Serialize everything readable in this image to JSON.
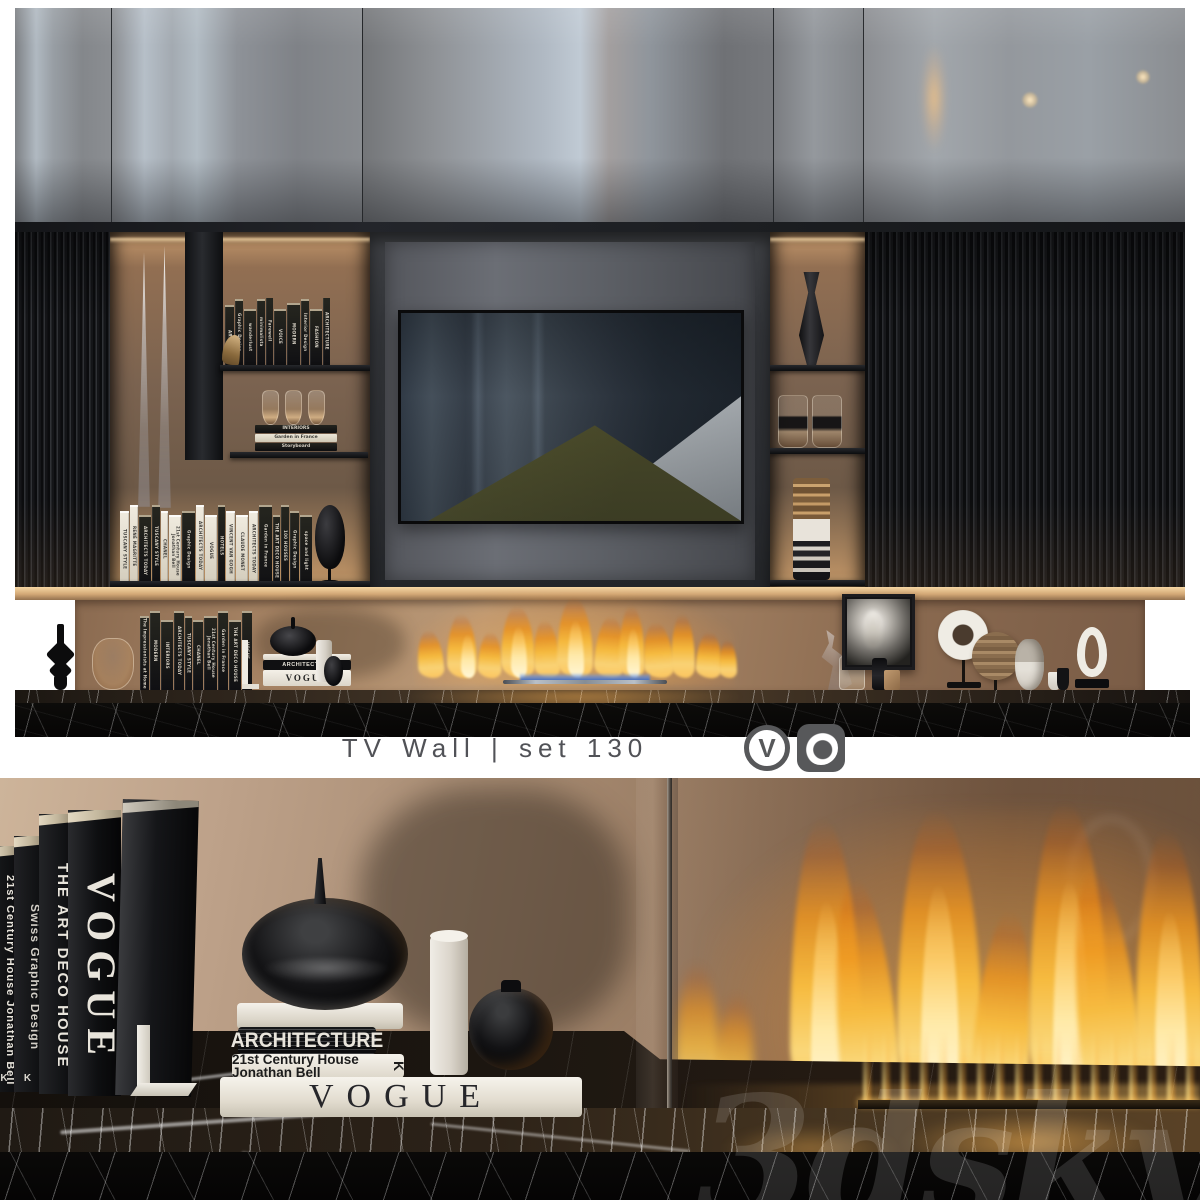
{
  "caption": {
    "title": "TV Wall | set 130",
    "renderer_logos": [
      {
        "name": "V-Ray",
        "glyph": "V"
      },
      {
        "name": "Corona Renderer"
      }
    ]
  },
  "watermark": "3dsky",
  "colors": {
    "flame": "#f6bb40",
    "flame_core": "#fff8da",
    "marble": "#0b0a09",
    "cabinet_gray": "#8e9094",
    "backdrop_bronze": "#a98a6d",
    "slat_black": "#1a1c1f",
    "caption_text": "#515257",
    "logo_gray": "#57585a"
  },
  "top_render": {
    "upper_shelf_books": [
      "ART",
      "Graphic Design",
      "wanderlust",
      "minimalista",
      "Farewell",
      "VOICE",
      "MODERN",
      "Interior Design",
      "FASHION",
      "ARCHITECTURE"
    ],
    "goblet_stack_books": [
      "INTERIORS",
      "Garden in France",
      "Storyboard"
    ],
    "lower_shelf_books": [
      {
        "t": "TUSCANY STYLE",
        "c": "w"
      },
      {
        "t": "RENÉ MAGRITTE",
        "c": "w"
      },
      {
        "t": "ARCHITECTS TODAY",
        "c": "b"
      },
      {
        "t": "TUSCANY STYLE",
        "c": "b"
      },
      {
        "t": "CHANEL",
        "c": "w"
      },
      {
        "t": "21st Century House Jonathan Bell",
        "c": "w"
      },
      {
        "t": "Graphic Design",
        "c": "b"
      },
      {
        "t": "ARCHITECTS TODAY",
        "c": "w"
      },
      {
        "t": "VOGUE",
        "c": "w"
      },
      {
        "t": "HOTELS",
        "c": "b"
      },
      {
        "t": "VINCENT VAN GOGH",
        "c": "w"
      },
      {
        "t": "CLAUDE MONET",
        "c": "w"
      },
      {
        "t": "ARCHITECTS TODAY",
        "c": "w"
      },
      {
        "t": "Garden in France",
        "c": "b"
      },
      {
        "t": "THE ART DECO HOUSE",
        "c": "b"
      },
      {
        "t": "100 HOUSES",
        "c": "b"
      },
      {
        "t": "Graphic Design",
        "c": "b"
      },
      {
        "t": "space and light",
        "c": "b"
      }
    ],
    "base_books": [
      "The Impressionists at Home",
      "MODERN",
      "INTERIORS",
      "ARCHITECTS TODAY",
      "TUSCANY STYLE",
      "CHANEL",
      "21st Century House Jonathan Bell",
      "Garden in France",
      "THE ART DECO HOUSE",
      "VOGUE"
    ],
    "base_stack": [
      "ARCHITECTURE",
      "VOGUE"
    ]
  },
  "detail_render": {
    "standing_books": [
      {
        "title": "21st Century House Jonathan Bell",
        "badge": "K"
      },
      {
        "title": "Swiss Graphic Design",
        "badge": "K"
      },
      {
        "title": "THE ART DECO HOUSE"
      },
      {
        "title": "VOGUE"
      }
    ],
    "stacked_books": {
      "second": "ARCHITECTURE",
      "third": "21st Century House Jonathan Bell",
      "third_badge": "K",
      "bottom": "VOGUE"
    }
  }
}
